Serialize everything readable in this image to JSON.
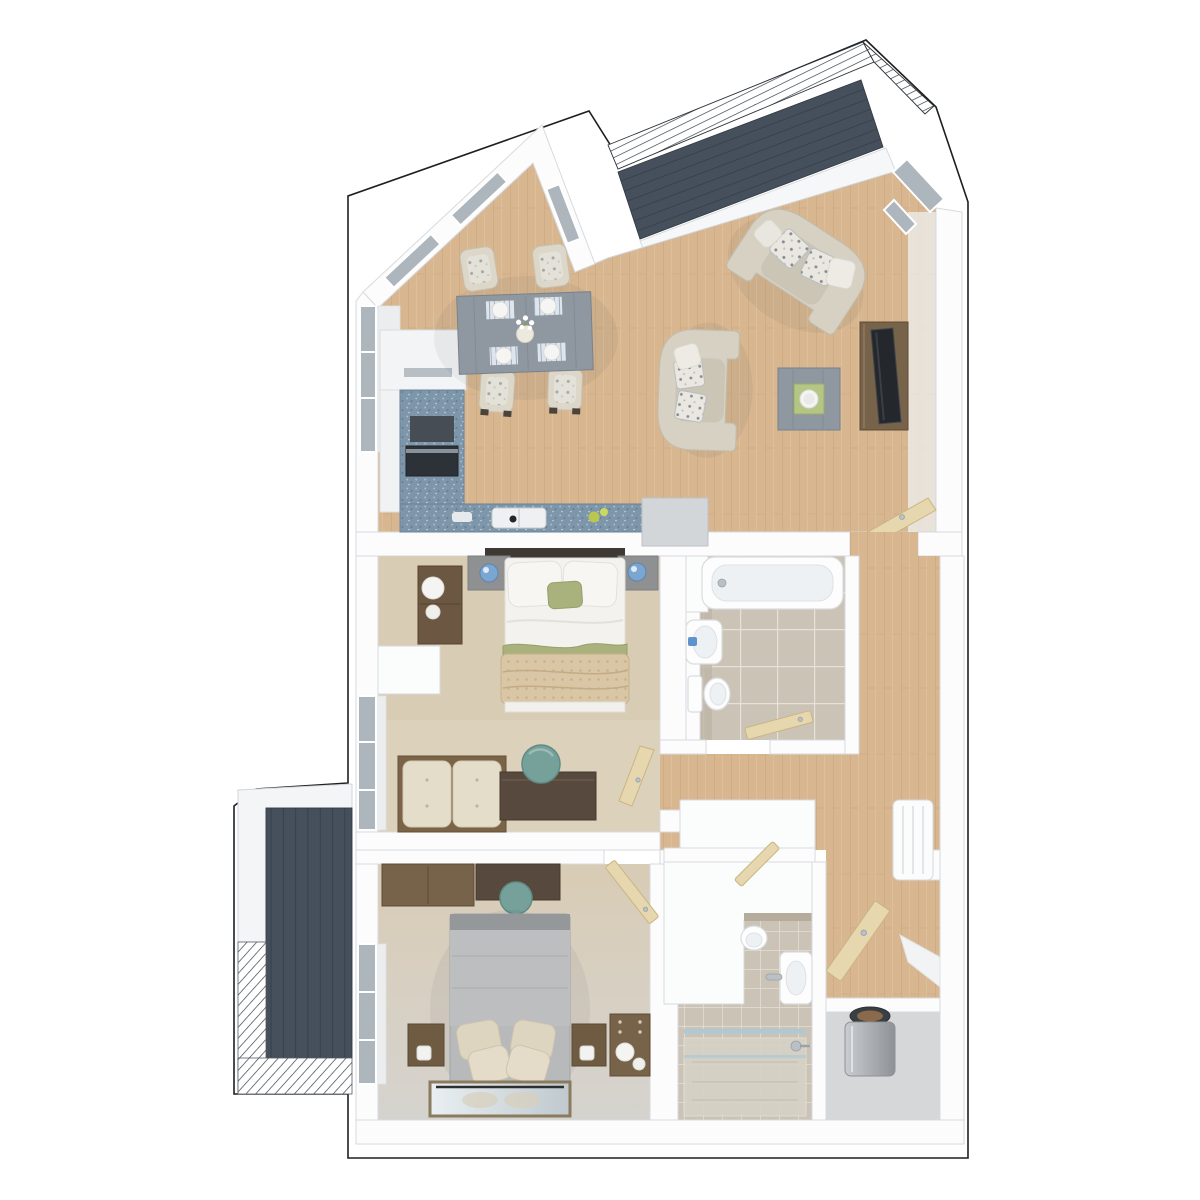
{
  "meta": {
    "label": "3D top-down architectural floor plan render of a two-bedroom apartment with open-plan kitchen living dining room, bathroom, shower room, hallway, storage, utility cupboard and two balconies",
    "view": "top-down 3D dollhouse render",
    "visible_text": []
  },
  "colors": {
    "outline": "#1d1f21",
    "wall": "#fcfcfd",
    "wall_edge": "#d7dade",
    "floor_wood": "#d8b690",
    "deck_slate": "#46505c",
    "tile_beige": "#cbc3b5",
    "counter_blue": "#7e96a9",
    "window_glass": "#aeb6bd",
    "door_tan": "#e7d7ae",
    "door_tan_edge": "#c9b483",
    "carpet_beige": "#d9ccb4",
    "sofa_cream": "#d6d1c3",
    "chair_cream": "#dcd7c9",
    "table_gray": "#8f98a1",
    "furniture_brown": "#77624a",
    "furniture_walnut": "#57493d",
    "headboard_dark": "#3f3933",
    "bed_white": "#f3f2ef",
    "accent_green": "#a9b27c",
    "throw_beige": "#d9c6a4",
    "bed2_gray": "#bcbec0",
    "pillow_cream": "#ded5c1",
    "stool_teal": "#76a09a",
    "lamp_blue": "#7ca6d2",
    "fixture_inner": "#eef1f3",
    "fixture_edge": "#d9dcde",
    "chrome": "#b9c0c6",
    "glass_blue": "#aac9d6",
    "tank_gray": "#aeb2b6",
    "copper": "#8a6a4a",
    "fruit_green": "#b8c84e",
    "mat_blue": "#7f9ab5"
  },
  "scene": {
    "rooms": [
      {
        "name": "open-plan-kitchen-living-dining",
        "floor": "wood",
        "furniture": [
          "dining-table",
          "dining-chair-x4",
          "place-setting-x4",
          "flower-vase",
          "kitchen-counter-l-shape",
          "tall-kitchen-unit",
          "oven",
          "kitchen-sink",
          "peninsula-cabinet",
          "sofa-top",
          "sofa-center",
          "coffee-table",
          "tv-unit",
          "tv",
          "door-to-hall"
        ]
      },
      {
        "name": "balcony-top",
        "floor": "slate-decking",
        "furniture": [
          "railing"
        ]
      },
      {
        "name": "bedroom-1",
        "floor": "beige-carpet",
        "furniture": [
          "double-bed",
          "headboard",
          "bedside-shelf-x2",
          "blue-lamp-x2",
          "tall-chest",
          "storage-bench",
          "dressing-table",
          "stool",
          "door"
        ]
      },
      {
        "name": "bathroom",
        "floor": "beige-tiles",
        "furniture": [
          "bathtub",
          "wash-basin",
          "toilet",
          "door"
        ]
      },
      {
        "name": "hallway",
        "floor": "wood",
        "furniture": [
          "storage-closet",
          "console-radiator",
          "door-x3"
        ]
      },
      {
        "name": "bedroom-2",
        "floor": "beige-carpet",
        "furniture": [
          "double-bed",
          "wardrobe",
          "dressing-table",
          "stool",
          "bedside-table-x2",
          "lamp-x2",
          "chest-of-drawers",
          "floor-mirror",
          "door"
        ]
      },
      {
        "name": "shower-room",
        "floor": "beige-tiles",
        "furniture": [
          "walk-in-shower",
          "glass-screen",
          "wash-basin",
          "toilet",
          "boxed-duct"
        ]
      },
      {
        "name": "storage-cupboard",
        "floor": "wood",
        "furniture": [
          "open-door"
        ]
      },
      {
        "name": "utility-cupboard",
        "floor": "gray",
        "furniture": [
          "hot-water-cylinder"
        ]
      },
      {
        "name": "balcony-left",
        "floor": "slate-decking",
        "furniture": [
          "railing",
          "privacy-wall"
        ]
      }
    ]
  }
}
